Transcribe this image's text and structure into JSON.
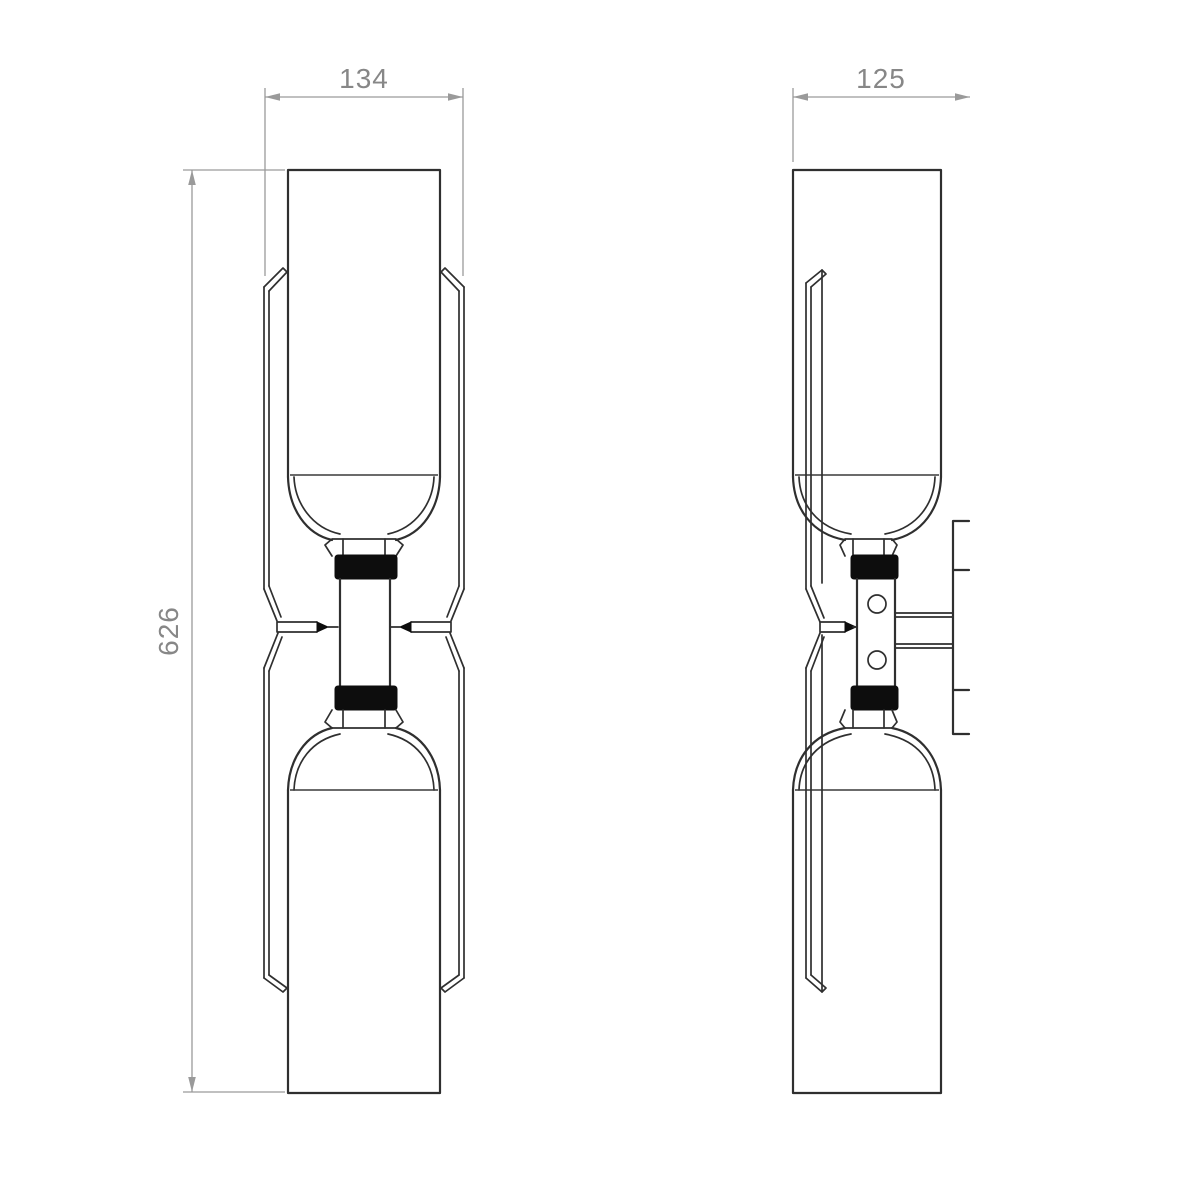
{
  "dimensions": {
    "front_width": "134",
    "side_depth": "125",
    "front_height": "626"
  },
  "colors": {
    "background": "#ffffff",
    "object_line": "#2f2f2f",
    "object_fill": "#0d0d0d",
    "dim_line": "#9a9a9a",
    "dim_text": "#878787"
  }
}
